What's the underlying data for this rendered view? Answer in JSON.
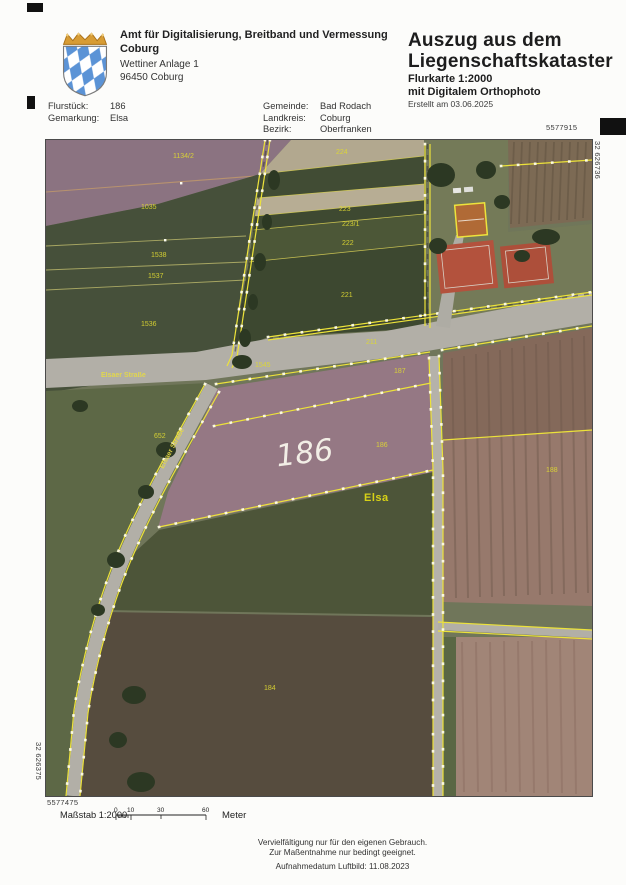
{
  "header": {
    "agency_line1": "Amt für Digitalisierung, Breitband und Vermessung",
    "agency_line2": "Coburg",
    "address_line1": "Wettiner Anlage 1",
    "address_line2": "96450 Coburg",
    "title_line1": "Auszug aus dem",
    "title_line2": "Liegenschaftskataster",
    "subtitle_line1": "Flurkarte 1:2000",
    "subtitle_line2": "mit Digitalem Orthophoto",
    "created": "Erstellt am 03.06.2025"
  },
  "info": {
    "flurstueck_label": "Flurstück:",
    "flurstueck_value": "186",
    "gemarkung_label": "Gemarkung:",
    "gemarkung_value": "Elsa",
    "gemeinde_label": "Gemeinde:",
    "gemeinde_value": "Bad Rodach",
    "landkreis_label": "Landkreis:",
    "landkreis_value": "Coburg",
    "bezirk_label": "Bezirk:",
    "bezirk_value": "Oberfranken"
  },
  "map": {
    "coord_top_right": "5577915",
    "coord_right_vertical": "32 626736",
    "coord_left_vertical": "32 626375",
    "coord_bottom_left": "5577475",
    "labels": [
      {
        "t": "1134/2",
        "x": 127,
        "y": 13
      },
      {
        "t": "1035",
        "x": 95,
        "y": 64
      },
      {
        "t": "1538",
        "x": 105,
        "y": 112
      },
      {
        "t": "1537",
        "x": 102,
        "y": 133
      },
      {
        "t": "1536",
        "x": 95,
        "y": 181
      },
      {
        "t": "224",
        "x": 290,
        "y": 9
      },
      {
        "t": "223",
        "x": 293,
        "y": 66
      },
      {
        "t": "223/1",
        "x": 296,
        "y": 81
      },
      {
        "t": "222",
        "x": 296,
        "y": 100
      },
      {
        "t": "221",
        "x": 295,
        "y": 152
      },
      {
        "t": "211",
        "x": 320,
        "y": 199
      },
      {
        "t": "1545",
        "x": 209,
        "y": 222
      },
      {
        "t": "187",
        "x": 348,
        "y": 228
      },
      {
        "t": "652",
        "x": 108,
        "y": 293
      },
      {
        "t": "186",
        "x": 330,
        "y": 302
      },
      {
        "t": "188",
        "x": 500,
        "y": 327
      },
      {
        "t": "184",
        "x": 218,
        "y": 545
      },
      {
        "t": "Elsaer Straße",
        "x": 55,
        "y": 232,
        "cls": "street"
      },
      {
        "t": "Elsaer Straße",
        "x": 104,
        "y": 305,
        "cls": "street",
        "rot": -62
      },
      {
        "t": "Elsa",
        "x": 318,
        "y": 352,
        "cls": "place"
      },
      {
        "t": "186",
        "x": 230,
        "y": 296,
        "cls": "big",
        "rot": -7
      }
    ]
  },
  "footer": {
    "scale_label": "Maßstab 1:2000",
    "scale_ticks": [
      "0",
      "10",
      "30",
      "60"
    ],
    "scale_unit": "Meter",
    "disclaimer_line1": "Vervielfältigung nur für den eigenen Gebrauch.",
    "disclaimer_line2": "Zur Maßentnahme nur bedingt geeignet.",
    "photo_date": "Aufnahmedatum Luftbild: 11.08.2023"
  },
  "colors": {
    "boundary_yellow": "#ece23a",
    "label_yellow": "#ded832",
    "highlight_white": "#f6f3ea",
    "roof_red": "#b3523d",
    "bavaria_blue": "#5b93d6"
  }
}
